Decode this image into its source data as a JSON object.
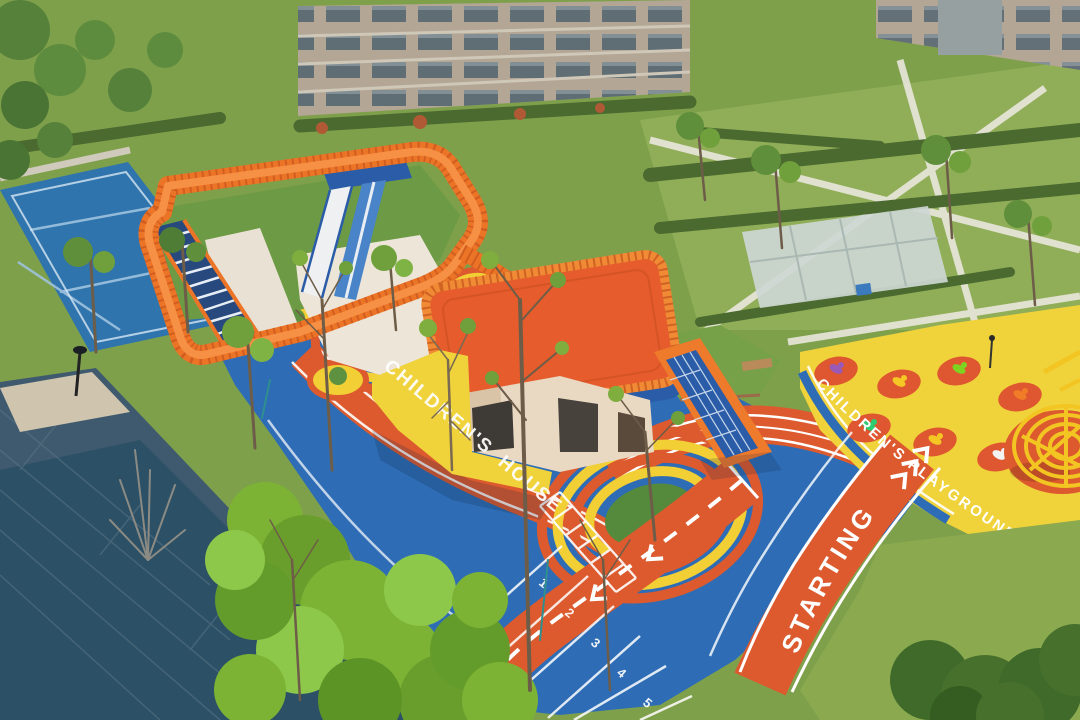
{
  "colors": {
    "surface_blue": "#2E6DB5",
    "track_orange": "#DC5A2E",
    "rail_orange": "#EC7426",
    "roof_orange": "#E65C2C",
    "play_yellow": "#F0D23A",
    "ring_yellow": "#F2CF35",
    "grass_base": "#7FA04B",
    "grass_bright": "#7CB335",
    "plaza_dark": "#2C5066",
    "sand_white": "#ECE5D8",
    "building_beige": "#B3A694",
    "court_blue": "#2F74AD",
    "marking_white": "#FFFFFF"
  },
  "ground_texts": {
    "children_house_line1": "CHILDREN'S",
    "children_house_line2": "HOUSE",
    "playground": "CHILDREN'S PLAYGROUND",
    "starting": "STARTING"
  },
  "track": {
    "lane_numbers": [
      "1",
      "2",
      "3",
      "4",
      "5",
      "6"
    ]
  },
  "playground": {
    "riders": [
      {
        "color": "#9B59B6"
      },
      {
        "color": "#F4C724"
      },
      {
        "color": "#7ED321"
      },
      {
        "color": "#F07C28"
      },
      {
        "color": "#2ECC71"
      },
      {
        "color": "#F4C724"
      },
      {
        "color": "#F2F2F2"
      }
    ]
  }
}
